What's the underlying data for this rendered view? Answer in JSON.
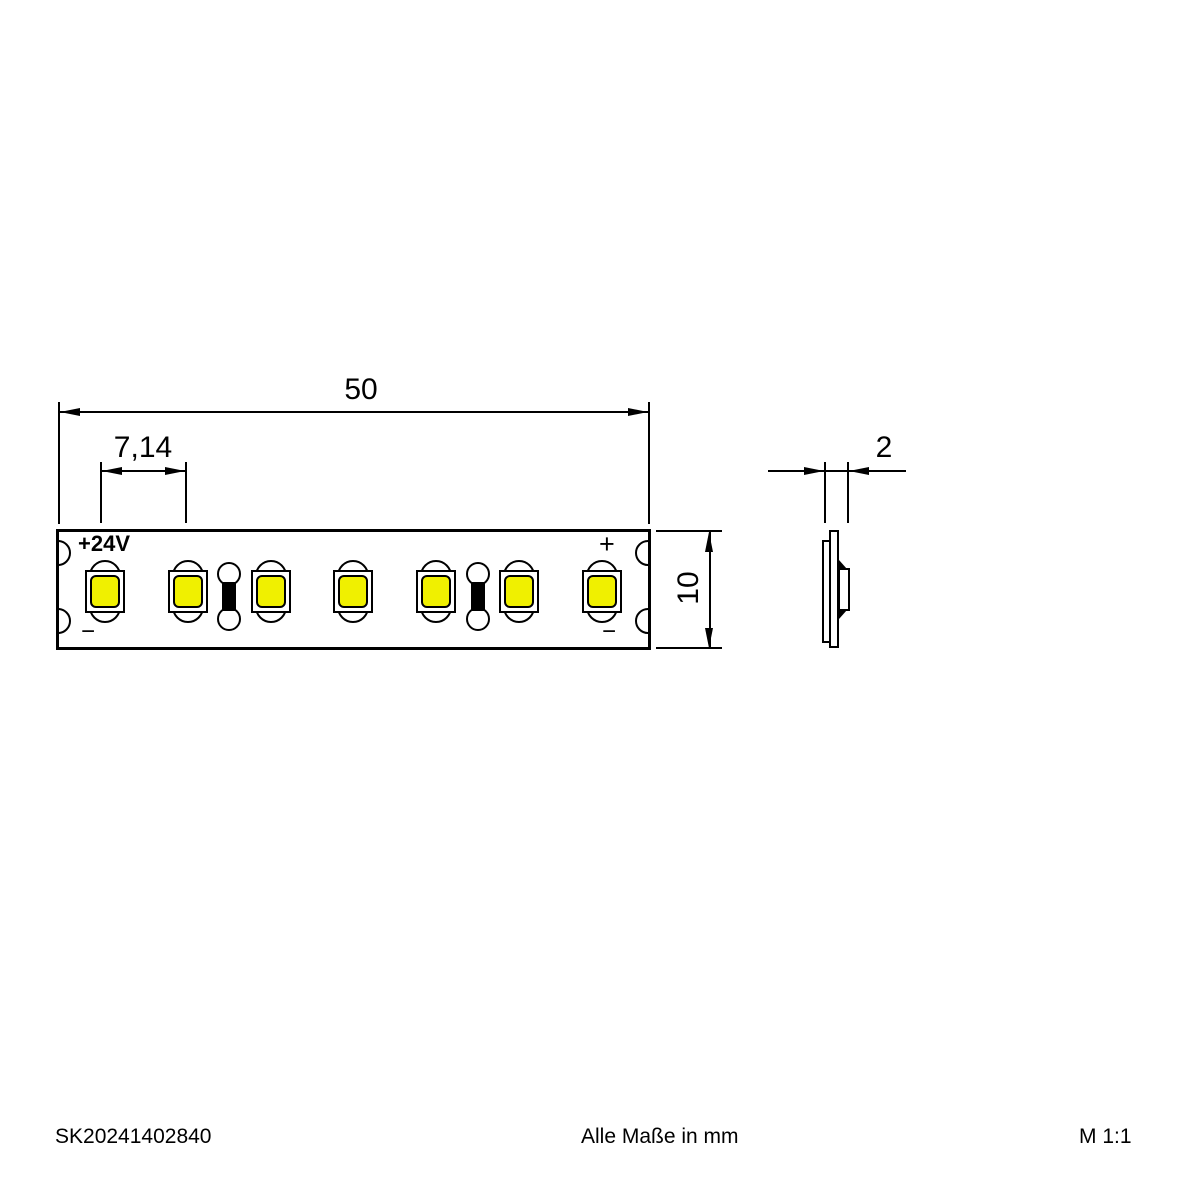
{
  "colors": {
    "line": "#000000",
    "background": "#ffffff",
    "led_fill": "#f0f000"
  },
  "top_view": {
    "dim_length": "50",
    "dim_pitch": "7,14",
    "dim_width": "10",
    "label_voltage": "+24V",
    "label_plus": "+",
    "label_minus_left": "−",
    "label_minus_right": "−",
    "led_count": 7,
    "resistor_positions": [
      2,
      5
    ]
  },
  "side_view": {
    "dim_thickness": "2"
  },
  "footer": {
    "doc_number": "SK20241402840",
    "note": "Alle Maße in mm",
    "scale": "M 1:1"
  }
}
